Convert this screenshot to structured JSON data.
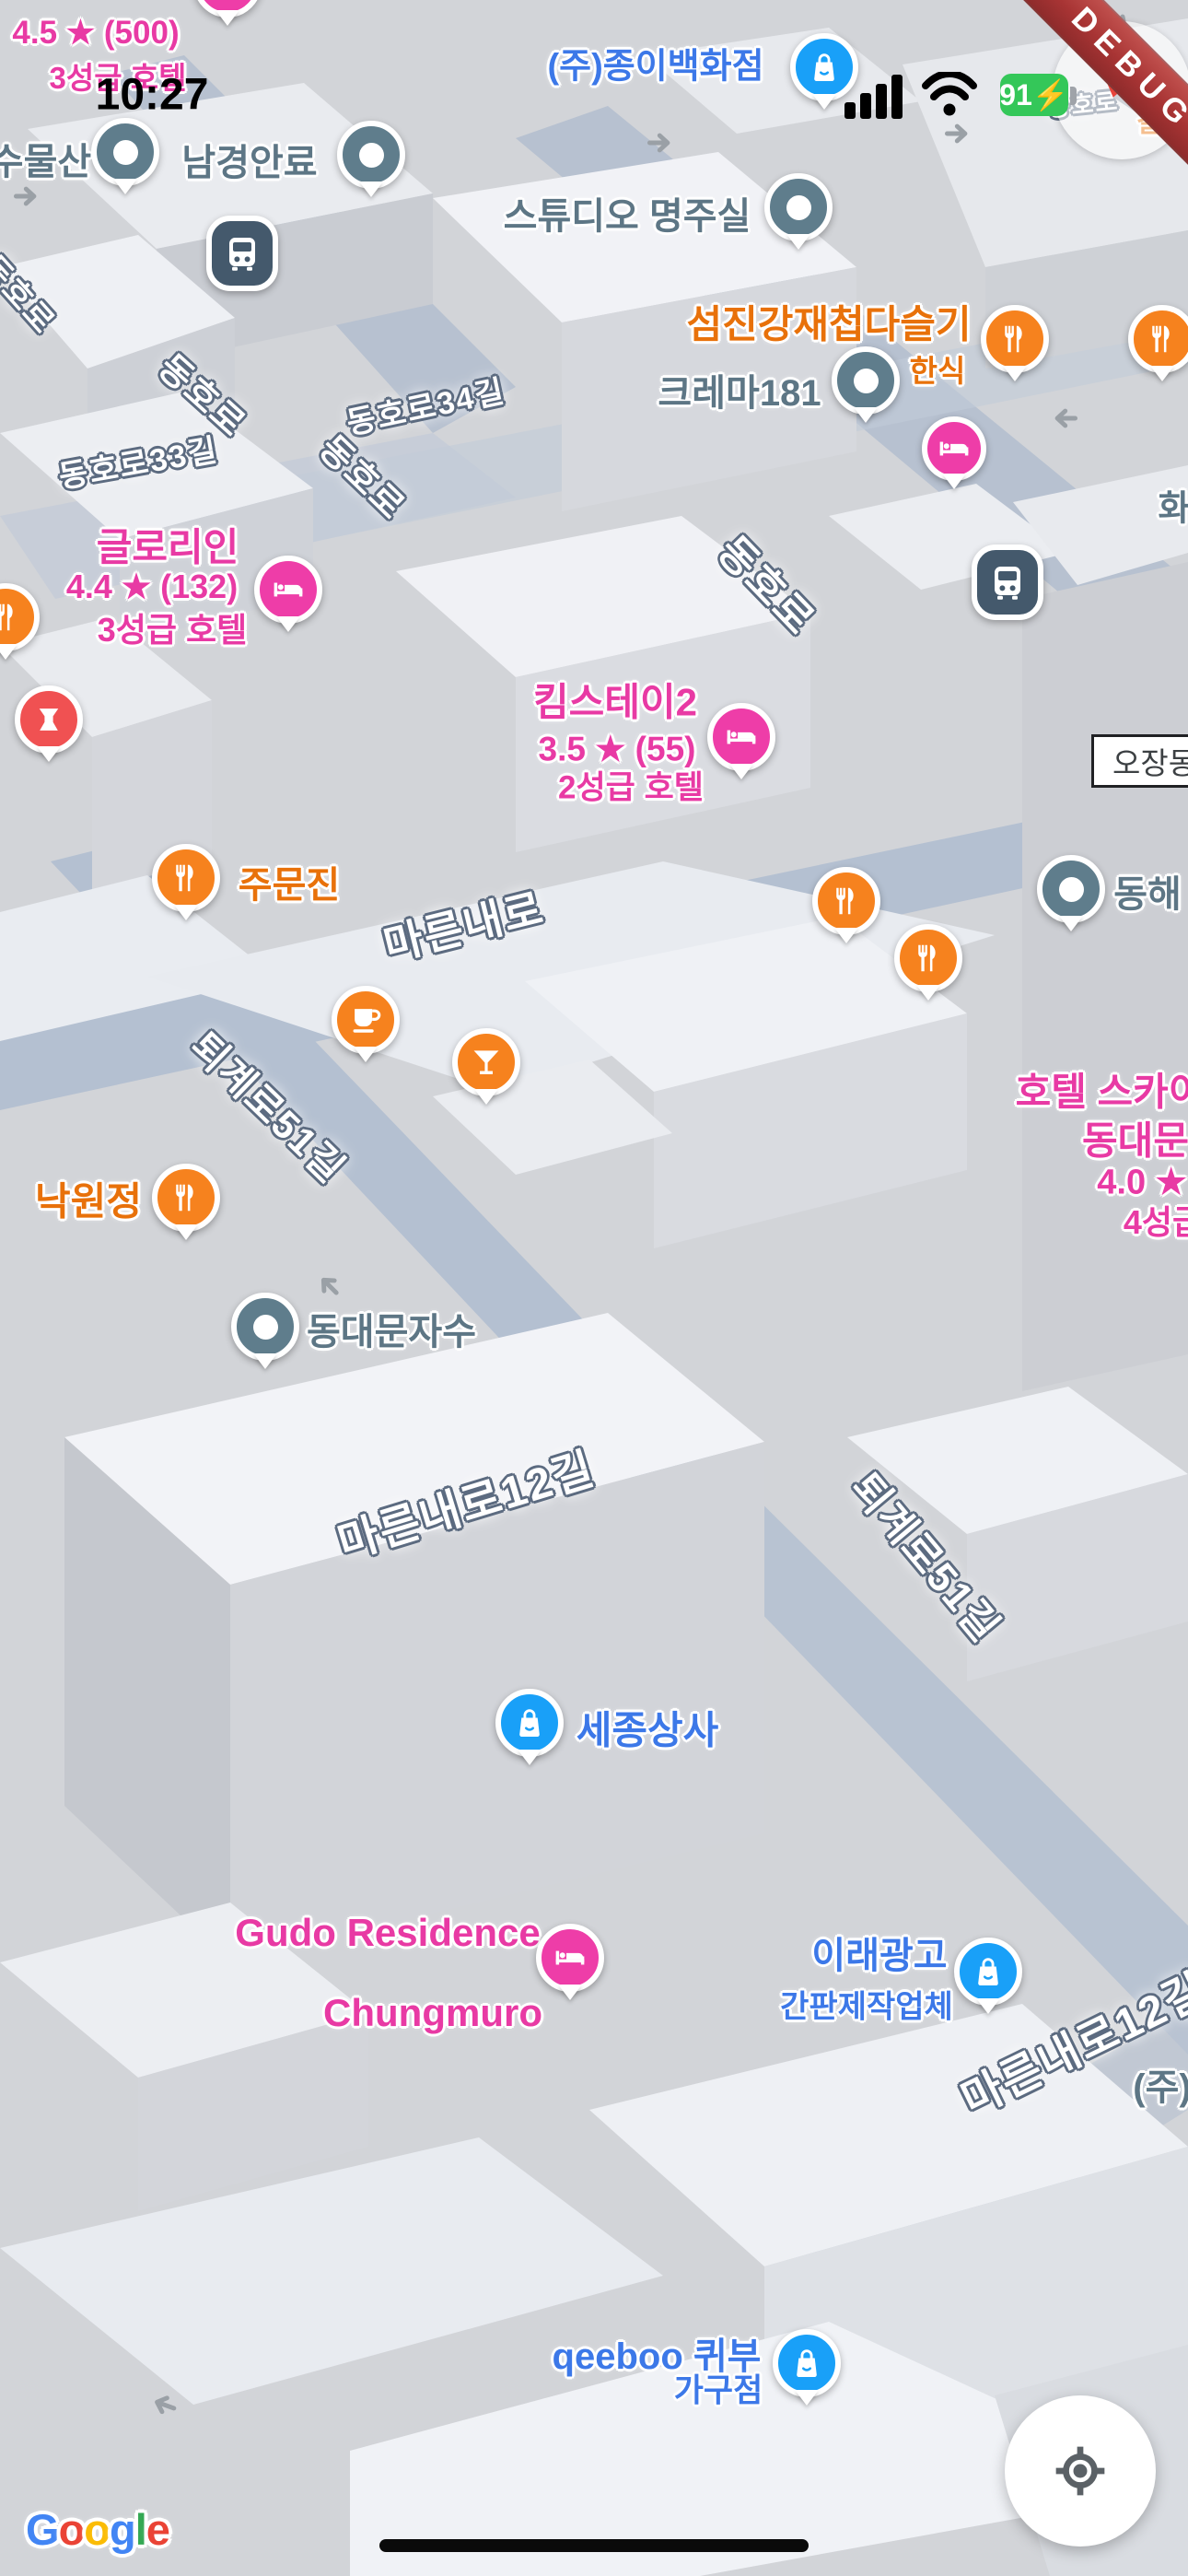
{
  "status_bar": {
    "time": "10:27",
    "battery": "91⚡",
    "signal_icon": "cellular-bars-full",
    "wifi_icon": "wifi-full"
  },
  "debug": {
    "label": "DEBUG"
  },
  "colors": {
    "pink_text": "#e83aa4",
    "orange_text": "#e8710a",
    "blue_text": "#3c78e8",
    "steel_text": "#5d7685",
    "pin_orange": "#f6821e",
    "pin_pink": "#ee3da8",
    "pin_blue": "#19a0f8",
    "pin_gray": "#5f7d8c",
    "pin_red": "#f05152",
    "bus_badge": "#44596c",
    "battery_green": "#34c759",
    "ribbon_red": "#a83434",
    "road_outline": "#5c6b80"
  },
  "roads": {
    "labels": [
      {
        "text": "동호로"
      },
      {
        "text": "동호로"
      },
      {
        "text": "동호로33길"
      },
      {
        "text": "동호로34길"
      },
      {
        "text": "동호로"
      },
      {
        "text": "동호로"
      },
      {
        "text": "동호로"
      },
      {
        "text": "마른내로"
      },
      {
        "text": "퇴계로51길"
      },
      {
        "text": "마른내로12길"
      },
      {
        "text": "퇴계로51길"
      },
      {
        "text": "마른내로12길"
      }
    ]
  },
  "pois": {
    "hotel_top": {
      "rating": "4.5 ★ (500)",
      "category": "3성급 호텔"
    },
    "sumulsan": {
      "label": "수물산"
    },
    "namgyeong": {
      "label": "남경안료"
    },
    "jongi": {
      "label": "(주)종이백화점"
    },
    "studio": {
      "label": "스튜디오 명주실"
    },
    "seomjingang": {
      "label": "섬진강재첩다슬기",
      "category": "한식"
    },
    "crema": {
      "label": "크레마181"
    },
    "hwa": {
      "label": "화"
    },
    "galbi": {
      "label": "갈비"
    },
    "gloryin": {
      "label": "글로리인",
      "rating": "4.4 ★ (132)",
      "category": "3성급 호텔"
    },
    "ojangdong": {
      "label": "오장동사"
    },
    "kimstay": {
      "label": "킴스테이2",
      "rating": "3.5 ★ (55)",
      "category": "2성급 호텔"
    },
    "jumunjin": {
      "label": "주문진"
    },
    "donghae": {
      "label": "동해"
    },
    "nakwonjeong": {
      "label": "낙원정"
    },
    "hotel_sky": {
      "line1": "호텔 스카이",
      "line2": "동대문",
      "line3": "4.0 ★",
      "line4": "4성급"
    },
    "dongdaemun_jasu": {
      "label": "동대문자수"
    },
    "sejong": {
      "label": "세종상사"
    },
    "gudo": {
      "line1": "Gudo Residence",
      "line2": "Chungmuro"
    },
    "irae": {
      "label": "이래광고",
      "category": "간판제작업체"
    },
    "ju": {
      "label": "(주)"
    },
    "qeeboo": {
      "line1": "qeeboo 퀴부",
      "line2": "가구점"
    }
  },
  "icons": {
    "restaurant": "fork-knife-icon",
    "hotel": "bed-icon",
    "shopping": "shopping-bag-icon",
    "cafe": "coffee-cup-icon",
    "bar": "cocktail-icon",
    "transit": "bus-icon",
    "herbal": "mortar-icon",
    "place": "dot-icon",
    "locate": "crosshair-icon",
    "compass": "compass-needle-icon",
    "arrow": "direction-arrow-icon"
  },
  "attribution": {
    "letters": [
      "G",
      "o",
      "o",
      "g",
      "l",
      "e"
    ]
  }
}
